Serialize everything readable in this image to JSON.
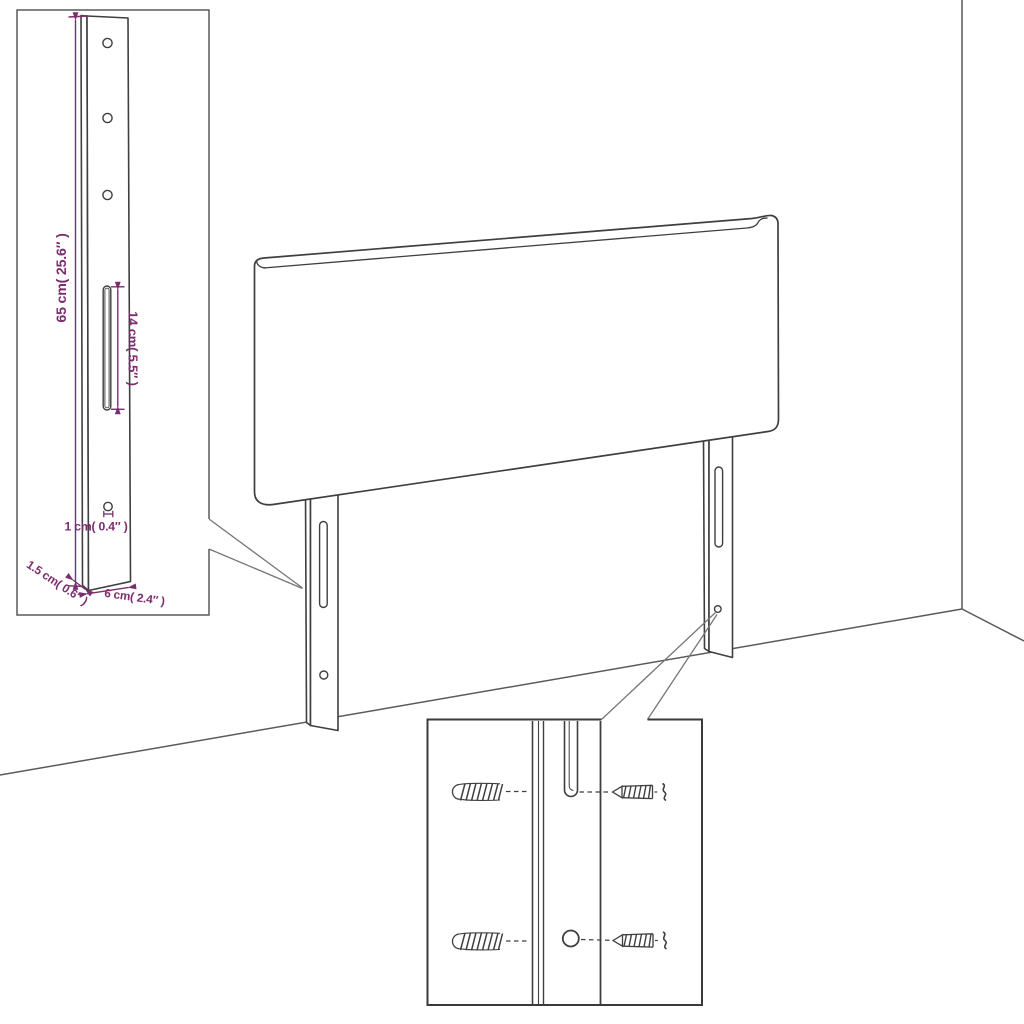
{
  "diagram": {
    "colors": {
      "background": "#ffffff",
      "line_art": "#3f3f3f",
      "wall_line": "#5a5a5a",
      "dimension_accent": "#7b2d6d"
    },
    "bracket_inset": {
      "height_label": "65 cm( 25.6″ )",
      "slot_label": "14 cm( 5.5″ )",
      "hole_label": "1 cm( 0.4″ )",
      "thickness_label": "1.5 cm( 0.6″ )",
      "width_label": "6 cm( 2.4″ )"
    },
    "hardware_inset": {
      "icons": [
        "wall-plug-icon",
        "screw-icon"
      ]
    }
  }
}
